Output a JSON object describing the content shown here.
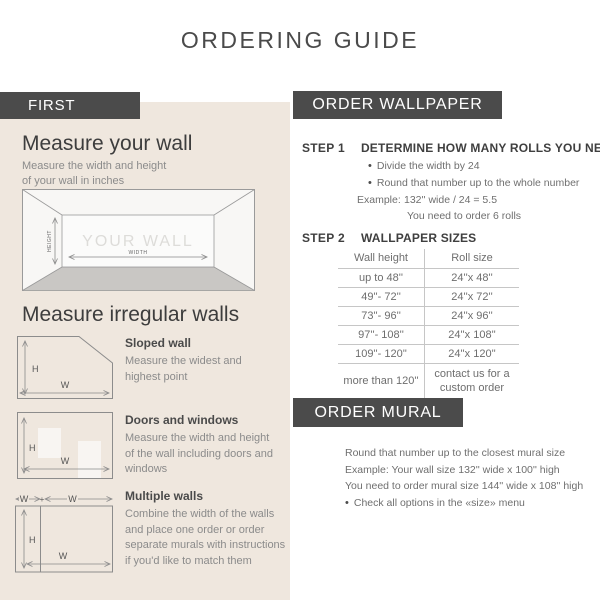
{
  "title": "ORDERING GUIDE",
  "glyphs": {
    "bullet": "•"
  },
  "colors": {
    "bar_bg": "#4b4b4b",
    "panel_bg": "#efe7de",
    "heading": "#3d3d3d",
    "body_text": "#6f6f6f",
    "floor_gray": "#c9c7c4"
  },
  "left_panel": {
    "header": "FIRST",
    "measure_wall": {
      "heading": "Measure your wall",
      "description": "Measure the width and height of your wall in inches",
      "diagram": {
        "wall_label": "YOUR WALL",
        "height_label": "HEIGHT",
        "width_label": "WIDTH"
      }
    },
    "irregular": {
      "heading": "Measure irregular walls",
      "diagram_labels": {
        "h": "H",
        "w": "W",
        "plus": "+"
      },
      "items": [
        {
          "title": "Sloped wall",
          "description": "Measure the widest and highest point"
        },
        {
          "title": "Doors and windows",
          "description": "Measure the width and height of the wall including doors and windows"
        },
        {
          "title": "Multiple walls",
          "description": "Combine the width of the walls and place one order or order separate murals with instructions if you'd like to match them"
        }
      ]
    }
  },
  "wallpaper": {
    "header": "ORDER WALLPAPER",
    "step1": {
      "label": "STEP 1",
      "title": "DETERMINE HOW MANY ROLLS YOU NEED",
      "bullets": [
        "Divide the width by 24",
        "Round that number up to the whole number"
      ],
      "example_label": "Example:",
      "example_value": "132'' wide / 24 = 5.5",
      "example_result": "You need to order 6 rolls"
    },
    "step2": {
      "label": "STEP 2",
      "title": "WALLPAPER SIZES",
      "table": {
        "headers": [
          "Wall height",
          "Roll size"
        ],
        "rows": [
          [
            "up to 48''",
            "24''x 48''"
          ],
          [
            "49''- 72''",
            "24''x 72''"
          ],
          [
            "73''- 96''",
            "24''x 96''"
          ],
          [
            "97''- 108''",
            "24''x 108''"
          ],
          [
            "109''- 120''",
            "24''x 120''"
          ],
          [
            "more than 120''",
            "contact us for a custom order"
          ]
        ]
      }
    }
  },
  "mural": {
    "header": "ORDER MURAL",
    "lines": [
      "Round that number up to the closest mural size",
      "Example: Your wall size 132'' wide x 100'' high",
      "You need to order mural size 144'' wide x 108'' high"
    ],
    "bullet_line": "Check all options in the «size» menu"
  }
}
